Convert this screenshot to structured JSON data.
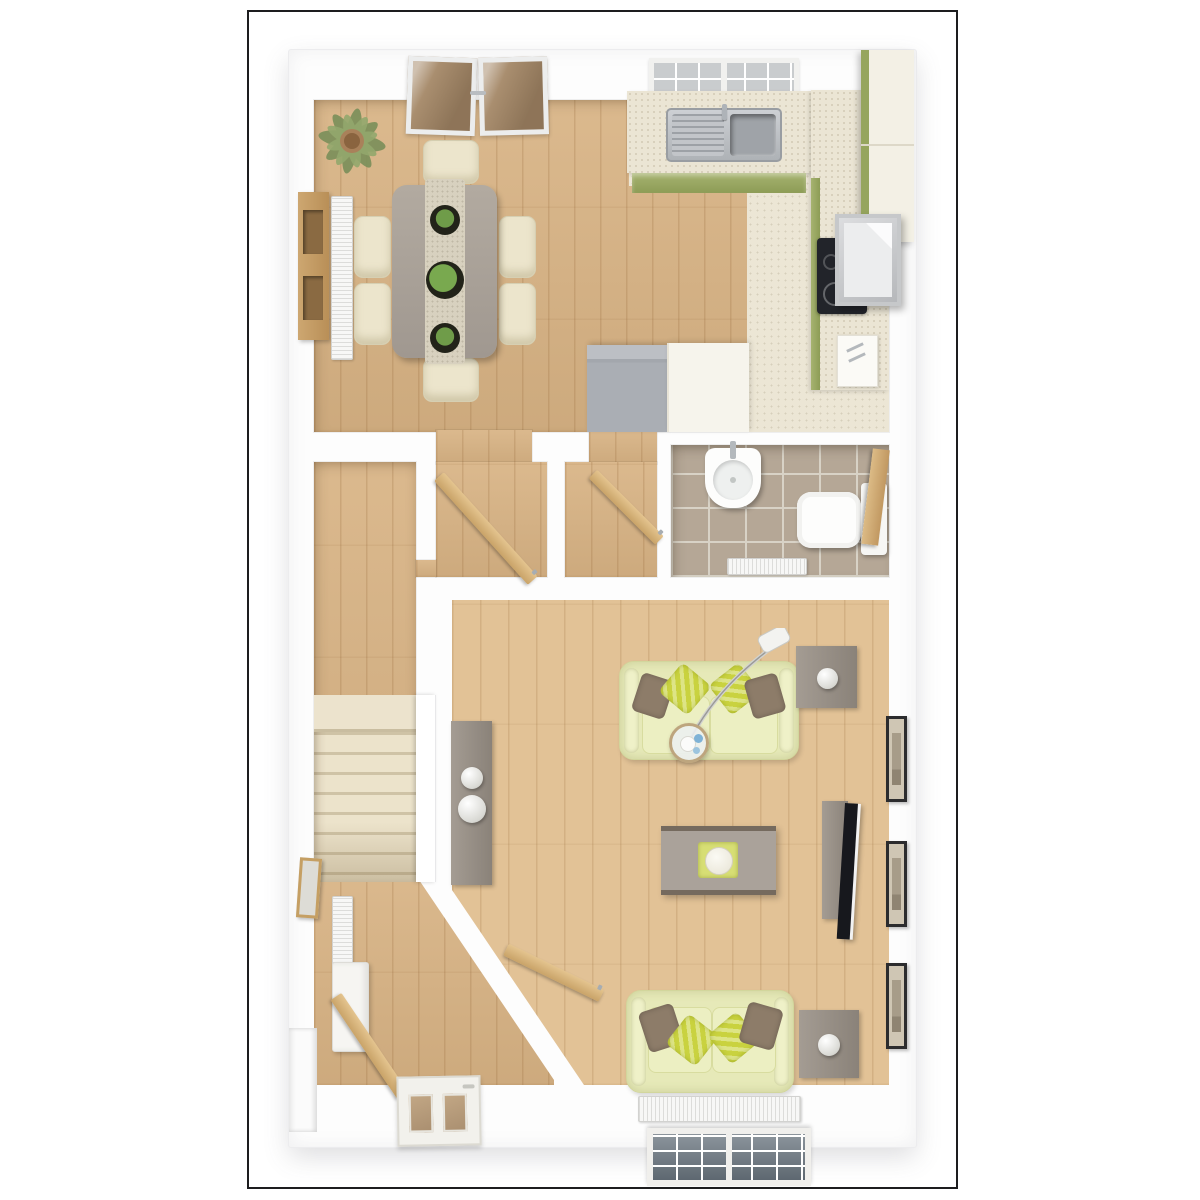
{
  "image": {
    "kind": "3D architectural floor plan render, top-down view",
    "floor": "ground floor",
    "no_visible_text": true
  },
  "palette": {
    "frame_border": "#1d1d1f",
    "background": "#ffffff",
    "walls": "#ffffff",
    "wood_floor": "#d8b384",
    "wood_floor_living": "#e2c296",
    "kitchen_tile_cream": "#ece6d5",
    "bathroom_tile": "#b5a796",
    "cabinet_green": "#9dac68",
    "worktop_cream": "#ebe5d4",
    "stairs_carpet": "#e9e0c8",
    "sofa_pale_green": "#e6e9b8",
    "cushion_lime": "#c9d23f",
    "cushion_brown": "#8d7c69",
    "grey_wood_furniture": "#a8a19a",
    "appliance_grey": "#aaaeb4",
    "sanitary_white": "#fdfdfd",
    "open_door_wood": "#d5b27e",
    "glass_tint_brown": "#a98e6f",
    "window_pane_grey": "#6b7680",
    "mirror_frame_gold": "#c59f63",
    "lemon_yellow": "#d9a921"
  },
  "rooms": [
    {
      "name": "dining-area",
      "furniture": [
        "french-doors",
        "palm-plant",
        "wall-shelf-unit",
        "radiator",
        "dining-table",
        "table-runner",
        "three-potted-plants",
        "six-cream-chairs"
      ]
    },
    {
      "name": "kitchen",
      "furniture": [
        "window",
        "worktop-with-sink-and-drainer",
        "serving-board-with-lemons",
        "green-base-cabinets",
        "tall-cabinets",
        "cooker-hood",
        "induction-hob",
        "fridge-unit",
        "counter-appliance",
        "small-appliance"
      ]
    },
    {
      "name": "inner-hallway",
      "furniture": [
        "open-door-to-dining",
        "open-door-to-kitchen",
        "store-cupboard"
      ]
    },
    {
      "name": "cloakroom-wc",
      "furniture": [
        "basin-with-tap",
        "toilet-with-cistern",
        "radiator",
        "open-wood-door"
      ]
    },
    {
      "name": "stairs-and-entrance-hall",
      "furniture": [
        "staircase",
        "banister-wall",
        "wall-mirror",
        "radiator",
        "console-shelf",
        "open-inner-door",
        "front-door-with-glazing",
        "entrance-recess"
      ]
    },
    {
      "name": "living-room",
      "furniture": [
        "sofa-three-seat",
        "sofa-two-seat",
        "arc-floor-lamp",
        "round-glass-table",
        "side-table-with-lamp",
        "second-side-table-with-lamp",
        "coffee-table-with-tray",
        "tall-console-with-bowls",
        "tv-unit",
        "flat-screen-tv",
        "three-wall-pictures",
        "radiator",
        "window"
      ]
    }
  ]
}
